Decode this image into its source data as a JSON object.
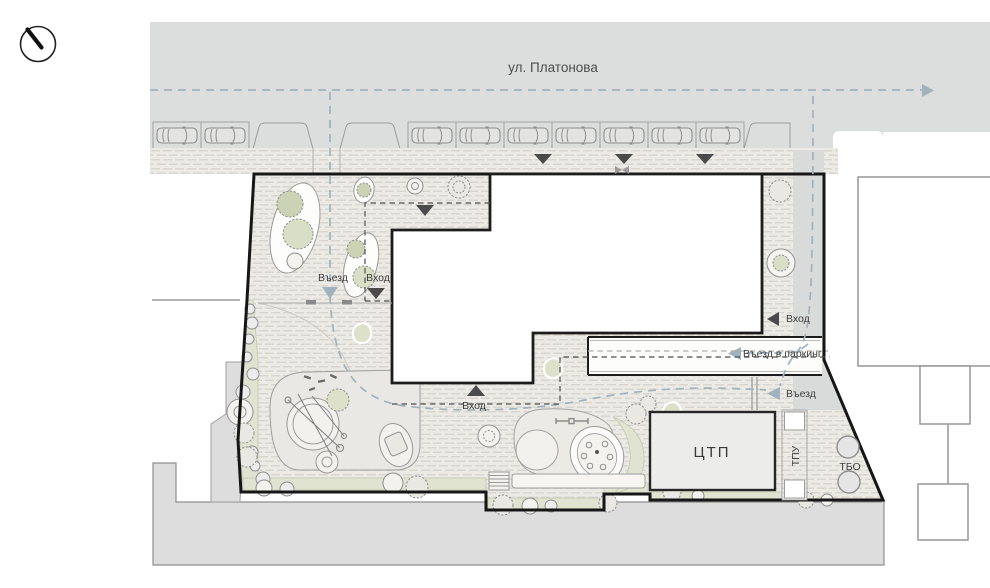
{
  "plan": {
    "street_name": "ул. Платонова",
    "labels": {
      "entry_drive_west": "Въезд",
      "entry_walk_west": "Вход",
      "entry_walk_east": "Вход",
      "entry_parking": "Въезд в паркинг",
      "entry_drive_se": "Въезд",
      "entry_walk_south": "Вход",
      "ctp": "ЦТП",
      "tpu": "ТПУ",
      "tbo": "ТБО"
    },
    "parking": {
      "bay_width": 48,
      "y": 122,
      "left": {
        "x": 153,
        "count": 2
      },
      "right": {
        "x": 408,
        "count": 7
      }
    },
    "colors": {
      "street_gray": "#dcdedd",
      "paving": "#ebeae5",
      "paving_dash": "#d8d6cf",
      "green": "#dfe3cf",
      "route_blue": "#9fb2bd",
      "arrow_dark": "#4a4a4a",
      "boundary": "#161616",
      "neighbor_stroke": "#979797"
    }
  }
}
